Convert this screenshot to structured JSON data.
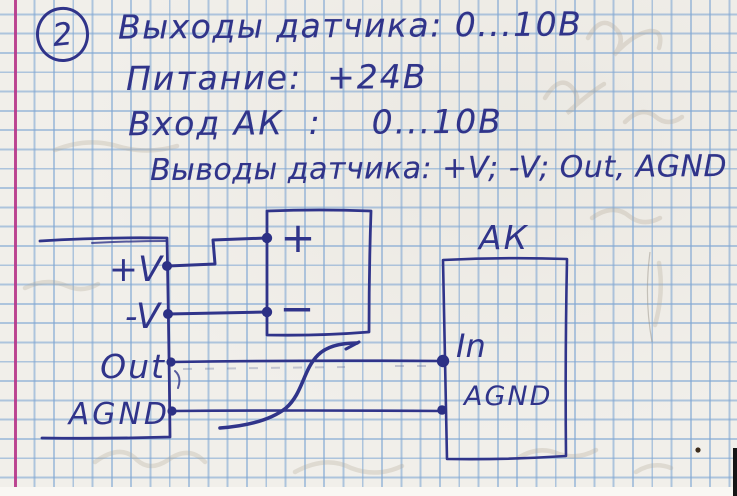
{
  "colors": {
    "ink_blue": "#30348a",
    "grid_blue": "#80a7d3",
    "paper": "#f1efea",
    "margin_pink": "#bb2e84"
  },
  "header": {
    "item_number": "2",
    "line1": "Выходы датчика: 0...10В",
    "line2": "Питание:  +24В",
    "line3": "Вход АК  :    0...10В",
    "line4": "Выводы датчика: +V; -V; Out, AGND"
  },
  "diagram": {
    "sensor_pins": {
      "vplus": "+V",
      "vminus": "-V",
      "out": "Out",
      "agnd": "AGND"
    },
    "supply": {
      "plus": "+",
      "minus": "−"
    },
    "ak": {
      "title": "АК",
      "in": "In",
      "agnd": "AGND"
    }
  }
}
